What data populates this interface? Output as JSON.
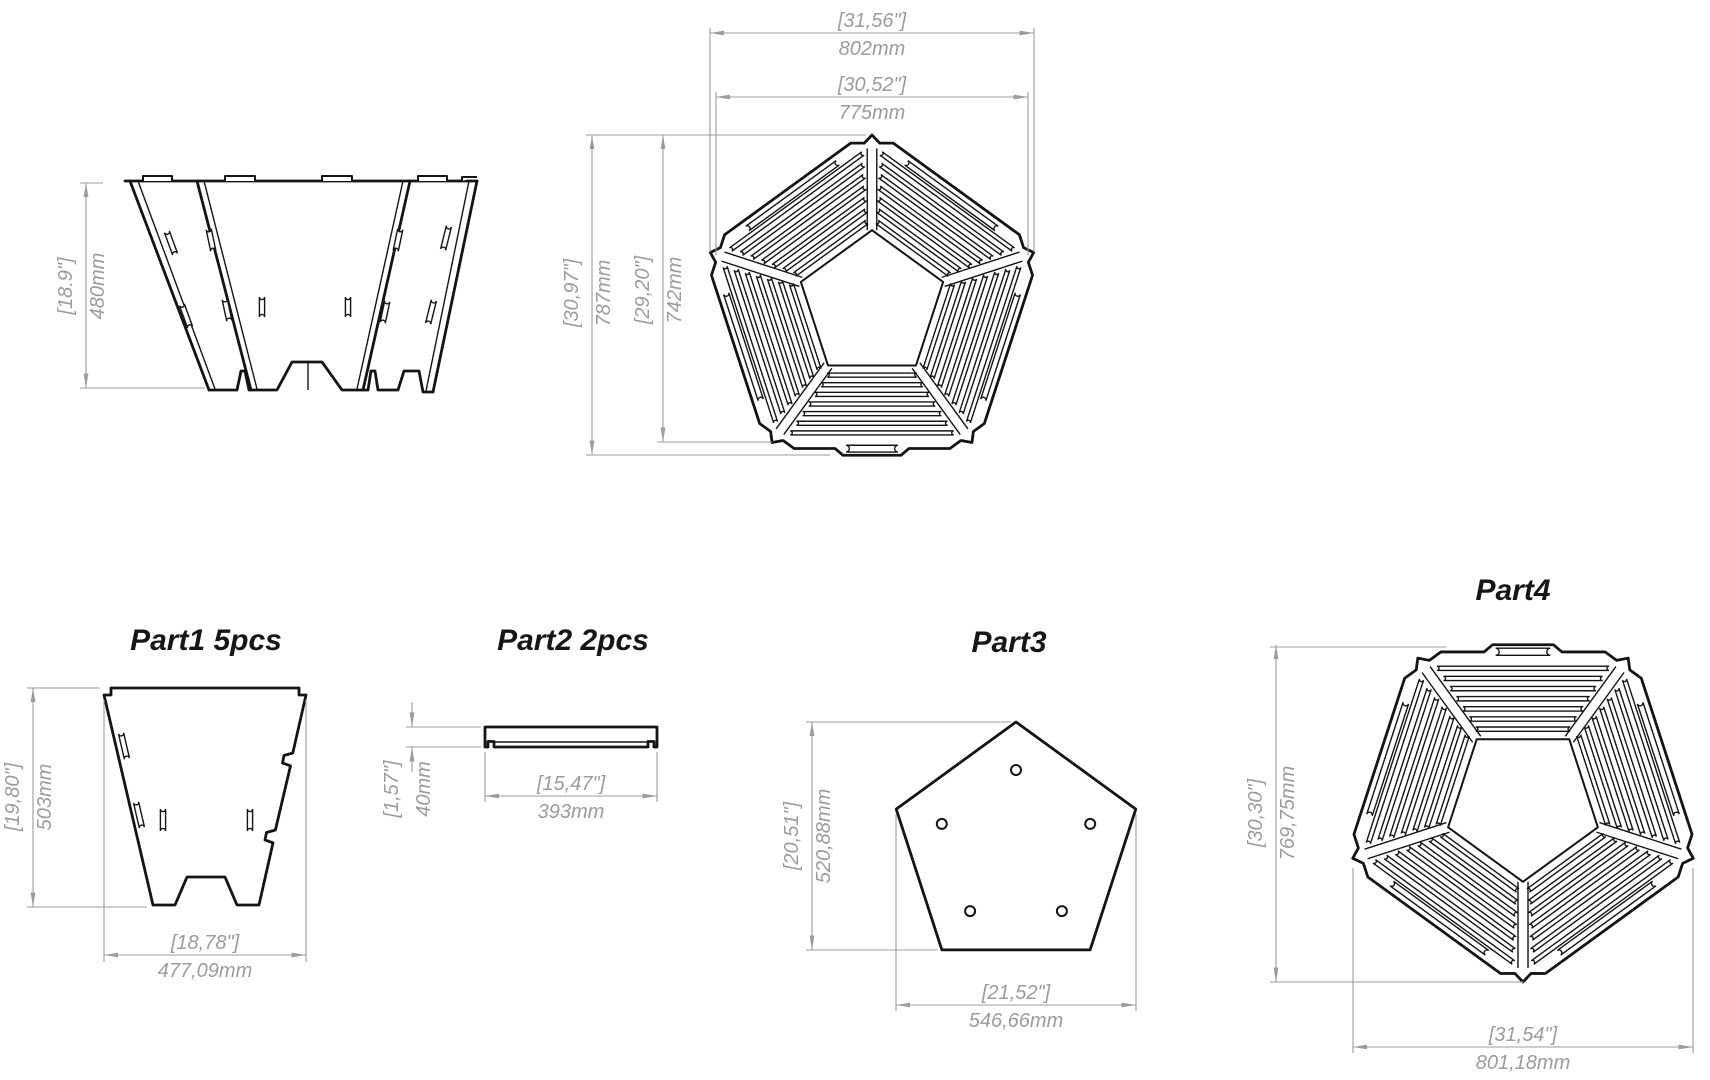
{
  "drawing": {
    "background": "#ffffff",
    "line_color": "#141414",
    "dim_color": "#9c9c9c",
    "views": {
      "side_view": {
        "name": "assembled-fire-pit-side-view",
        "height_in": "[18.9\"]",
        "height_mm": "480mm"
      },
      "top_view": {
        "name": "assembled-fire-pit-top-view",
        "outer_width_in": "[31,56\"]",
        "outer_width_mm": "802mm",
        "inner_width_in": "[30,52\"]",
        "inner_width_mm": "775mm",
        "outer_height_in": "[30,97\"]",
        "outer_height_mm": "787mm",
        "inner_height_in": "[29,20\"]",
        "inner_height_mm": "742mm"
      },
      "part1": {
        "label": "Part1 5pcs",
        "height_in": "[19,80\"]",
        "height_mm": "503mm",
        "width_in": "[18,78\"]",
        "width_mm": "477,09mm"
      },
      "part2": {
        "label": "Part2 2pcs",
        "height_in": "[1,57\"]",
        "height_mm": "40mm",
        "width_in": "[15,47\"]",
        "width_mm": "393mm"
      },
      "part3": {
        "label": "Part3",
        "height_in": "[20,51\"]",
        "height_mm": "520,88mm",
        "width_in": "[21,52\"]",
        "width_mm": "546,66mm"
      },
      "part4": {
        "label": "Part4",
        "height_in": "[30,30\"]",
        "height_mm": "769,75mm",
        "width_in": "[31,54\"]",
        "width_mm": "801,18mm"
      }
    }
  }
}
